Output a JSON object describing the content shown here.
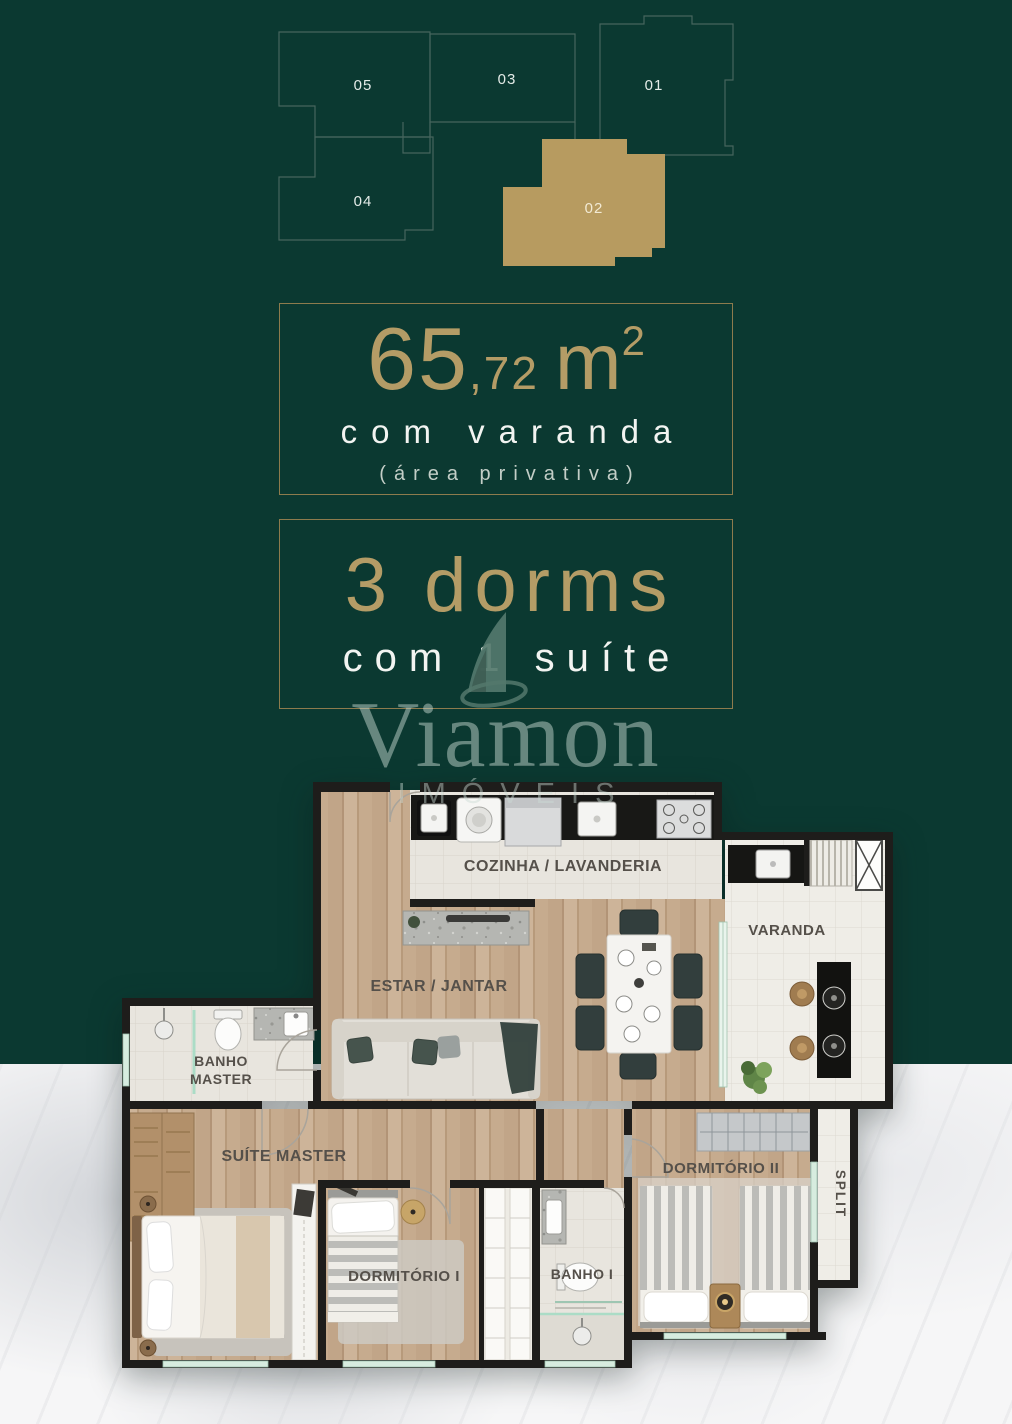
{
  "page": {
    "background_green": "#0b3931",
    "accent_gold": "#b49c66",
    "marble_white": "#f6f6f7"
  },
  "keyplan": {
    "units": [
      {
        "id": "05",
        "highlighted": false
      },
      {
        "id": "03",
        "highlighted": false
      },
      {
        "id": "01",
        "highlighted": false
      },
      {
        "id": "04",
        "highlighted": false
      },
      {
        "id": "02",
        "highlighted": true
      }
    ],
    "highlight_color": "#b79b60"
  },
  "area_box": {
    "value": "65",
    "decimal": ",72",
    "unit": "m",
    "unit_exponent": "2",
    "subtitle": "com varanda",
    "note": "(área privativa)"
  },
  "dorms_box": {
    "title": "3 dorms",
    "subtitle": "com 1 suíte"
  },
  "watermark": {
    "brand": "Viamon",
    "brand_sub": "IMÓVEIS"
  },
  "floorplan": {
    "rooms": {
      "kitchen": "COZINHA / LAVANDERIA",
      "living": "ESTAR / JANTAR",
      "balcony": "VARANDA",
      "master_bath_line1": "BANHO",
      "master_bath_line2": "MASTER",
      "master_suite": "SUÍTE MASTER",
      "bedroom1": "DORMITÓRIO I",
      "bath1": "BANHO I",
      "bedroom2": "DORMITÓRIO II",
      "split": "SPLIT"
    }
  }
}
